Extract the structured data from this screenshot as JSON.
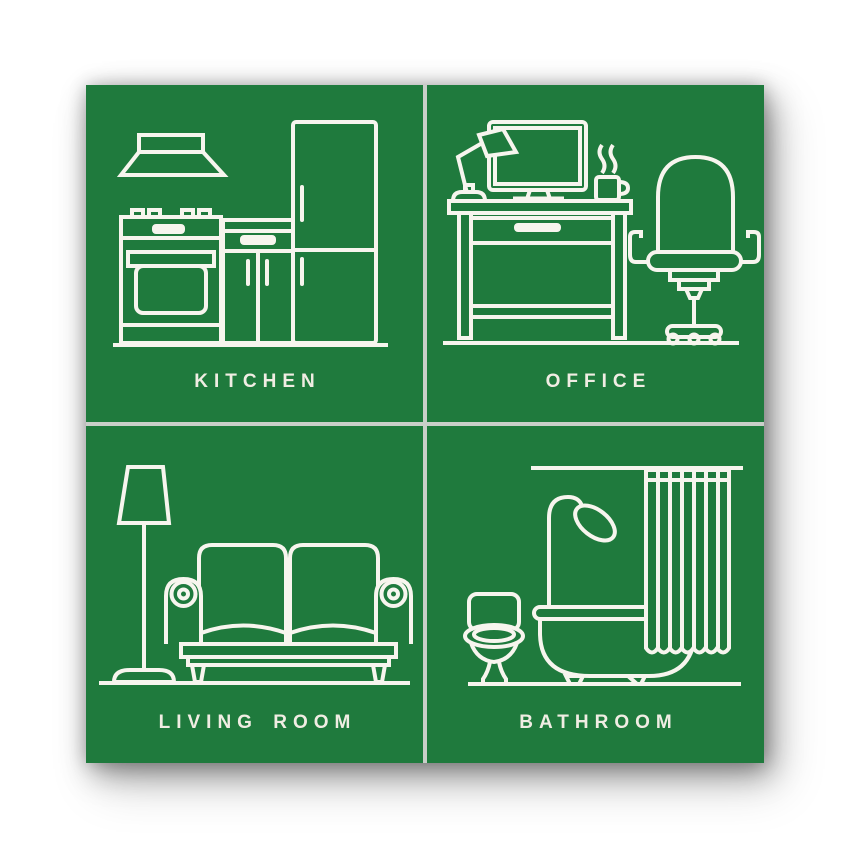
{
  "poster": {
    "colors": {
      "tile-green": "#1f7a3d",
      "line-white": "#f7f5ee",
      "label-cream": "#f0ede3",
      "gutter": "#c9cfc9",
      "page-bg": "#ffffff"
    },
    "tiles": [
      {
        "label": "KITCHEN",
        "icon": "kitchen-stove-hood-fridge-cabinet"
      },
      {
        "label": "OFFICE",
        "icon": "desk-monitor-lamp-mug-office-chair"
      },
      {
        "label": "LIVING ROOM",
        "icon": "floor-lamp-sofa"
      },
      {
        "label": "BATHROOM",
        "icon": "toilet-bathtub-shower-curtain"
      }
    ]
  }
}
